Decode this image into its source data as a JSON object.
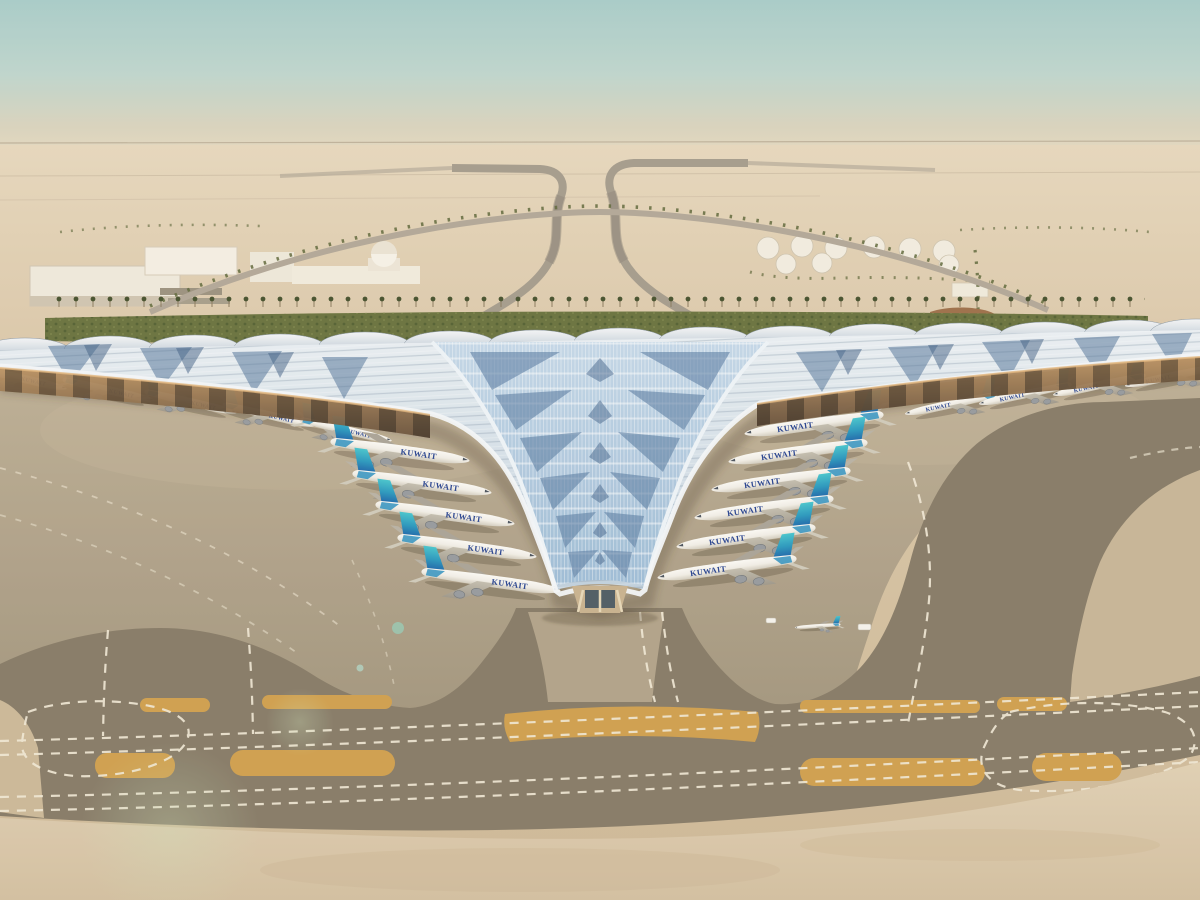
{
  "scene": {
    "kind": "aerial-architectural-rendering",
    "subject": "airport terminal with trident-shaped solar-panel roof in desert, aircraft parked at gates",
    "airline_label": "KUWAIT",
    "counts": {
      "aircraft_left_wing_gates": 5,
      "aircraft_left_pier_gates": 5,
      "aircraft_right_pier_gates": 6,
      "aircraft_right_wing_gates": 4,
      "fuel_tanks": 9
    },
    "colors": {
      "sky_top": "#a7ccc9",
      "sky_horizon": "#e3d8c0",
      "desert": "#e0cfb2",
      "sand_foreground": "#d8c5a6",
      "apron_concrete": "#b3a58b",
      "asphalt_taxiway": "#857a66",
      "taxiway_marking": "#f1e9d6",
      "island_yellow": "#cf9f4c",
      "roof_silver": "#dfe7ec",
      "roof_solar_blue": "#9dbcd6",
      "roof_solar_dark": "#51759c",
      "canopy_underside_amber": "#b9905f",
      "tail_teal": "#3fc0ca",
      "tail_blue": "#1b62a8",
      "fuselage_white": "#f4f2ec",
      "airline_text": "#24418f",
      "greenery": "#68713d"
    }
  }
}
